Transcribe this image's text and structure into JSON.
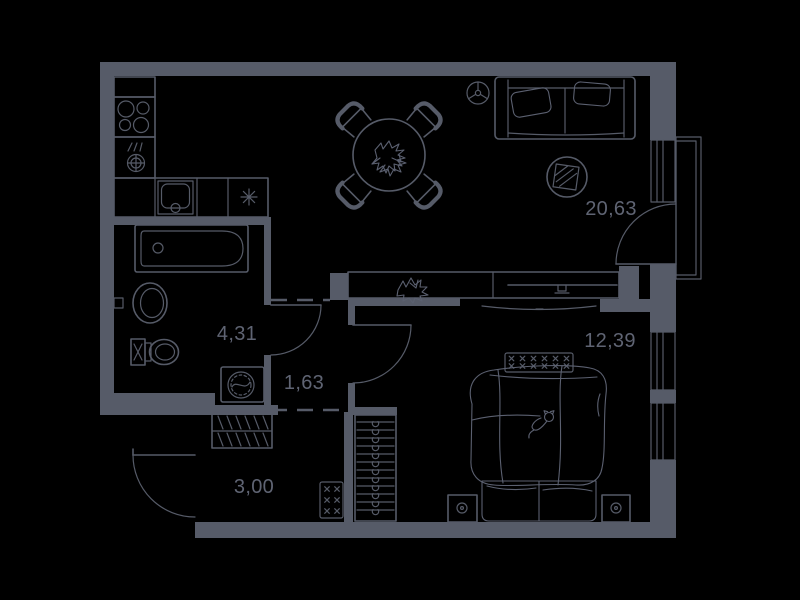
{
  "floor_plan": {
    "background_color": "#000000",
    "ink_color": "#565b68",
    "rooms": [
      {
        "name": "living-room-kitchen",
        "area": "20,63"
      },
      {
        "name": "bedroom",
        "area": "12,39"
      },
      {
        "name": "bathroom",
        "area": "4,31"
      },
      {
        "name": "inner-hall",
        "area": "1,63"
      },
      {
        "name": "entry-hall",
        "area": "3,00"
      }
    ],
    "symbols": [
      "stove-burners",
      "kitchen-sink",
      "faucet",
      "fridge-asterisk",
      "dining-table-with-plant",
      "chair",
      "ceiling-light",
      "sofa",
      "floor-symbol-hatched-square",
      "tv-cabinet-with-plant",
      "tv",
      "balcony",
      "window",
      "door-swing",
      "bathtub",
      "washbasin",
      "toilet",
      "washing-machine",
      "coat-hooks",
      "wardrobe-hangers",
      "electrical-panel",
      "bed-with-duvet",
      "cat",
      "nightstand",
      "radiator"
    ]
  }
}
